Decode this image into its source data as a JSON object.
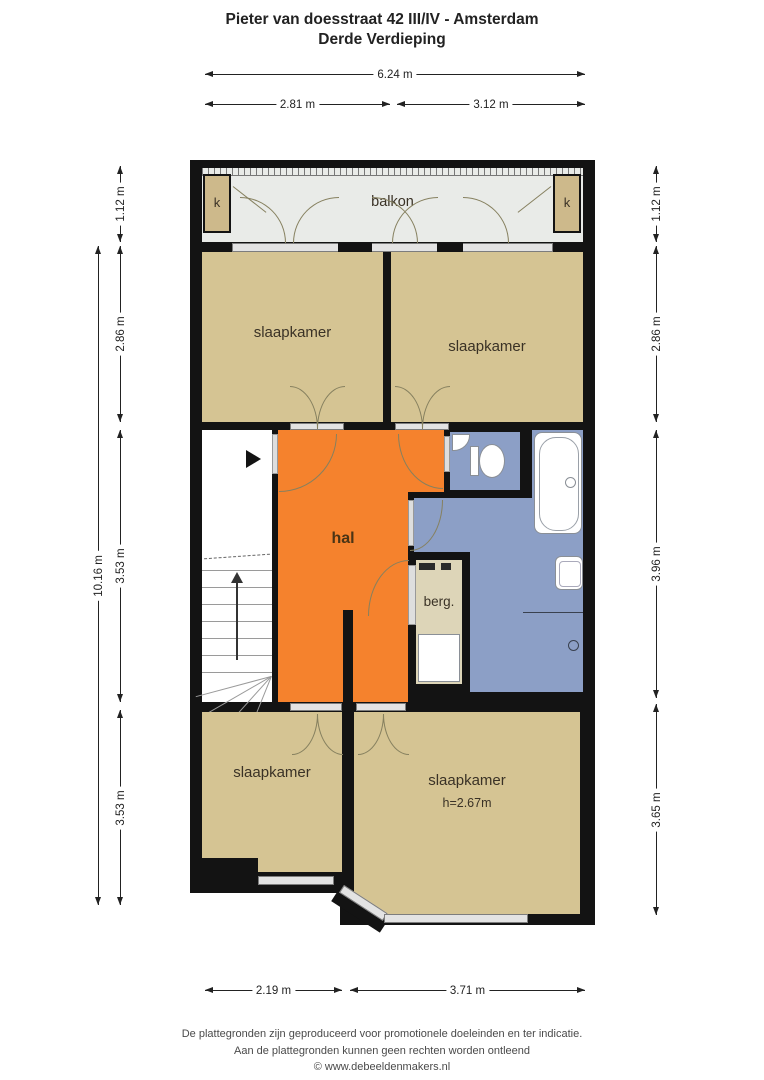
{
  "title": {
    "line1": "Pieter van doesstraat 42 III/IV - Amsterdam",
    "line2": "Derde Verdieping"
  },
  "rooms": {
    "balcony": "balkon",
    "closet_left": "k",
    "closet_right": "k",
    "bedroom_top_left": "slaapkamer",
    "bedroom_top_right": "slaapkamer",
    "hall": "hal",
    "storage": "berg.",
    "bedroom_bottom_left": "slaapkamer",
    "bedroom_bottom_right": "slaapkamer",
    "bedroom_bottom_right_height": "h=2.67m"
  },
  "dimensions": {
    "top_total": "6.24 m",
    "top_left": "2.81 m",
    "top_right": "3.12 m",
    "left_balcony": "1.12 m",
    "left_total": "10.16 m",
    "left_bedrooms": "2.86 m",
    "left_middle": "3.53 m",
    "left_bottom": "3.53 m",
    "right_balcony": "1.12 m",
    "right_bedrooms": "2.86 m",
    "right_middle": "3.96 m",
    "right_bottom": "3.65 m",
    "bottom_left": "2.19 m",
    "bottom_right": "3.71 m"
  },
  "footer": {
    "line1": "De plattegronden zijn geproduceerd voor promotionele doeleinden en ter indicatie.",
    "line2": "Aan de plattegronden kunnen geen rechten worden ontleend",
    "line3": "© www.debeeldenmakers.nl"
  },
  "colors": {
    "wall": "#131313",
    "floor_tan": "#d5c493",
    "hall_orange": "#f5822d",
    "bathroom_blue": "#8c9fc6",
    "balcony_grey": "#e9ebe8",
    "storage_cream": "#ddd5b8",
    "window_grey": "#e3e3e3"
  }
}
